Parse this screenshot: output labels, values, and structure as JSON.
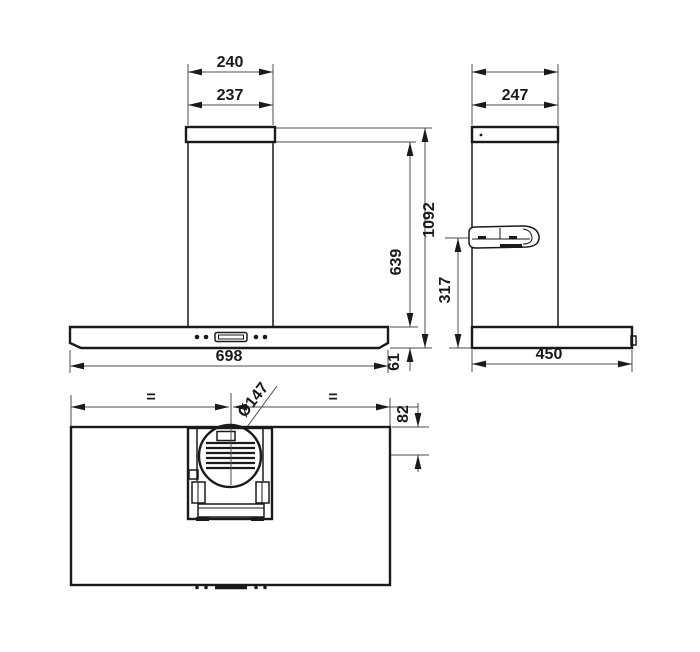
{
  "dimensions": {
    "front": {
      "chimney_top_outer": "240",
      "chimney_top_inner": "237",
      "total_height": "1092",
      "chimney_height": "639",
      "body_width": "698",
      "body_height": "61"
    },
    "side": {
      "chimney_depth": "247",
      "bracket_height": "317",
      "body_depth": "450"
    },
    "top": {
      "duct_diameter": "Ø147",
      "duct_offset": "82",
      "equal_left": "=",
      "equal_right": "="
    }
  },
  "colors": {
    "object_line": "#1a1a1a",
    "dimension_line": "#4d4d4d",
    "background": "#ffffff"
  }
}
